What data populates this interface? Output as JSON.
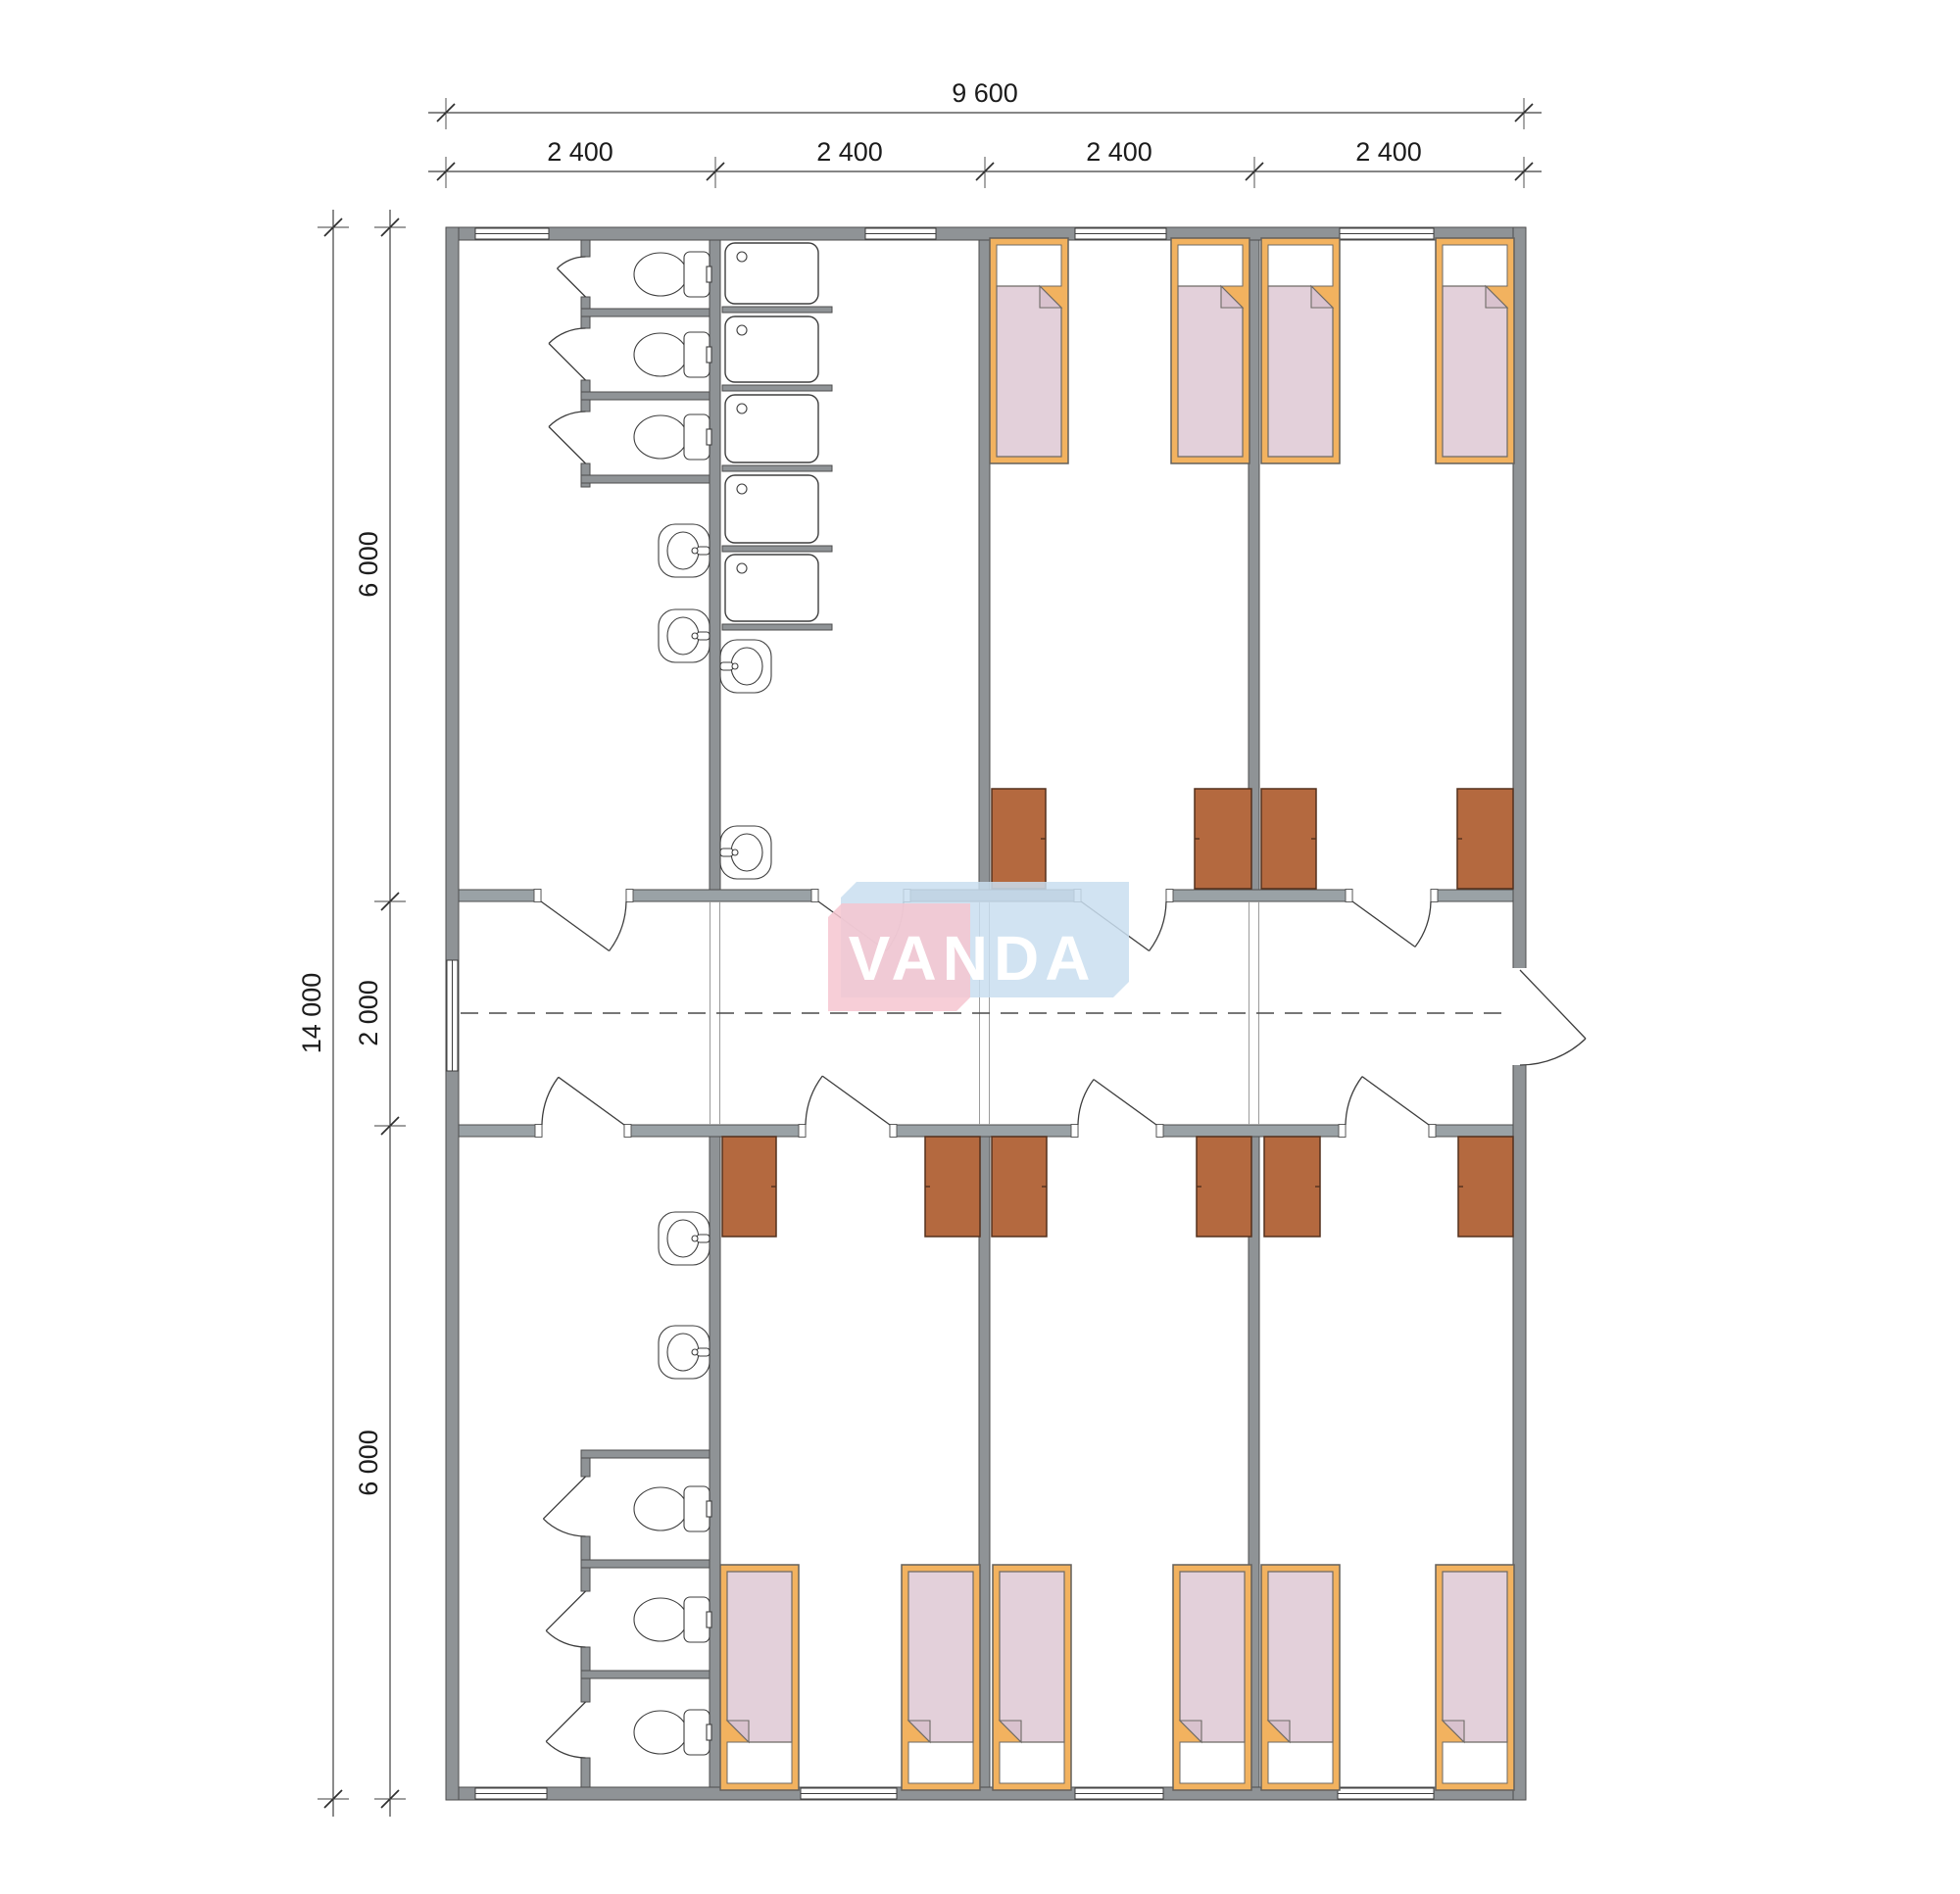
{
  "drawing": {
    "type": "architectural floor plan",
    "building": "modular dormitory, 4 modules x 2400 mm, central corridor"
  },
  "dims": {
    "top_total": "9 600",
    "top_segments": [
      "2 400",
      "2 400",
      "2 400",
      "2 400"
    ],
    "left_total": "14 000",
    "left_segments": [
      "6 000",
      "2 000",
      "6 000"
    ]
  },
  "logo": {
    "text": "VANDA",
    "pink": "rgba(246,198,208,0.85)",
    "blue": "rgba(201,222,240,0.85)",
    "text_color": "#FFFFFF"
  },
  "colors": {
    "wall": "#8F9396",
    "corridor_wall": "#9AA2A6",
    "wall_edge": "#4E4E4E",
    "bed_frame": "#F2B25F",
    "mattress": "#E3D0DA",
    "mattress_fold": "#D9C2CE",
    "pillow": "#FFFFFF",
    "wardrobe": "#B4693F",
    "fixture_line": "#3E3E3E",
    "dimension_line": "#3F3F3F",
    "dimension_text": "#1C1C1C"
  },
  "fixtures": {
    "beds": 10,
    "wardrobes": 10,
    "toilets": 6,
    "shower_trays": 5,
    "sinks": 6,
    "windows": 9,
    "room_doors": 8,
    "wc_stall_doors": 6,
    "entrance_doors": 1
  }
}
